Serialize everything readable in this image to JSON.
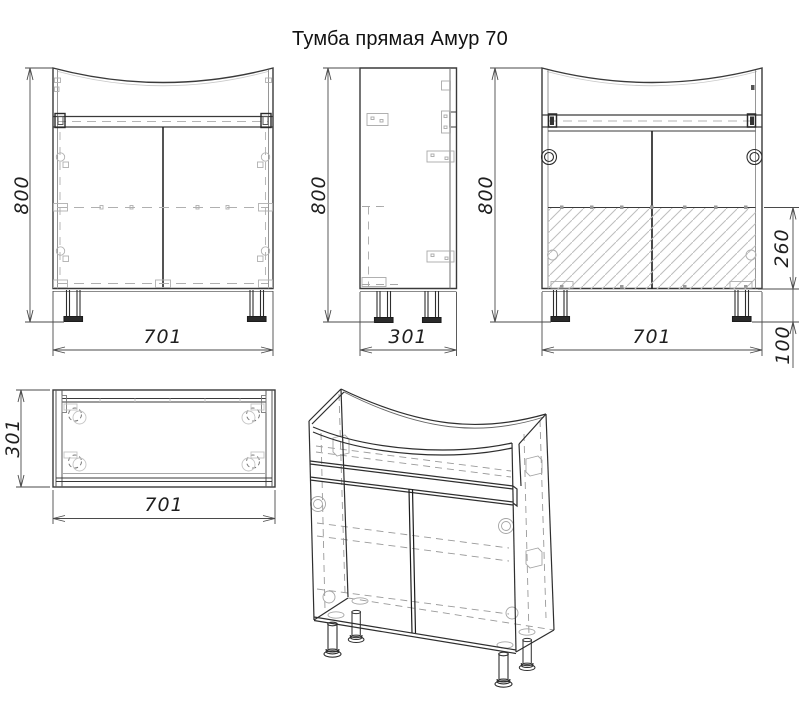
{
  "title": "Тумба прямая Амур 70",
  "dimensions_mm": {
    "width": 701,
    "depth": 301,
    "height": 800,
    "back_panel_height": 260,
    "leg_height": 100
  },
  "views": {
    "front": {
      "height_label": "800",
      "width_label": "701"
    },
    "side": {
      "height_label": "800",
      "width_label": "301"
    },
    "back": {
      "height_label": "800",
      "width_label": "701",
      "panel_height_label": "260",
      "leg_height_label": "100"
    },
    "top": {
      "depth_label": "301",
      "width_label": "701"
    }
  },
  "colors": {
    "line": "#3a3a3a",
    "dark": "#1c1c1c",
    "secondary": "#a5a5a5",
    "hatch": "#bdbdbd",
    "dimension": "#4a4a4a",
    "background": "#ffffff"
  }
}
